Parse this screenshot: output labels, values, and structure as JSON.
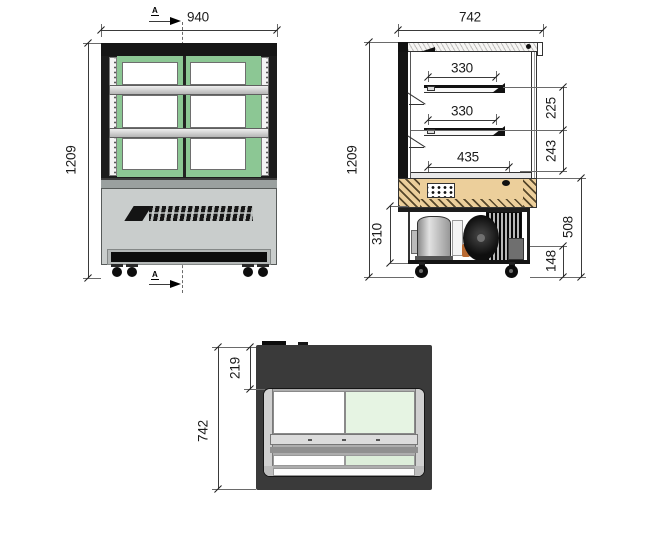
{
  "drawing": {
    "type": "technical-orthographic-drawing",
    "subject": "refrigerated display cabinet - front, side and plan views with dimensions (mm)",
    "views": {
      "front": {
        "section_marker": "A",
        "dims": {
          "overall_width": "940",
          "overall_height": "1209"
        }
      },
      "side": {
        "dims": {
          "overall_depth": "742",
          "overall_height": "1209",
          "shelf_top_depth": "330",
          "shelf_mid_depth": "330",
          "base_deck_depth": "435",
          "shelf_gap_upper": "225",
          "shelf_gap_lower": "243",
          "machine_bay_height": "310",
          "base_section_height": "508",
          "caster_height": "148"
        }
      },
      "top": {
        "dims": {
          "front_overhang": "219",
          "overall_depth": "742"
        }
      }
    },
    "colors": {
      "frame_black": "#1b1b1b",
      "glass_trim_green": "#8cc794",
      "glass_tint_light_green": "#e6f4e3",
      "base_gray": "#c9cdcc",
      "counter_wood_tan": "#eccf9b",
      "plan_body_dark": "#3a3a3a"
    }
  }
}
